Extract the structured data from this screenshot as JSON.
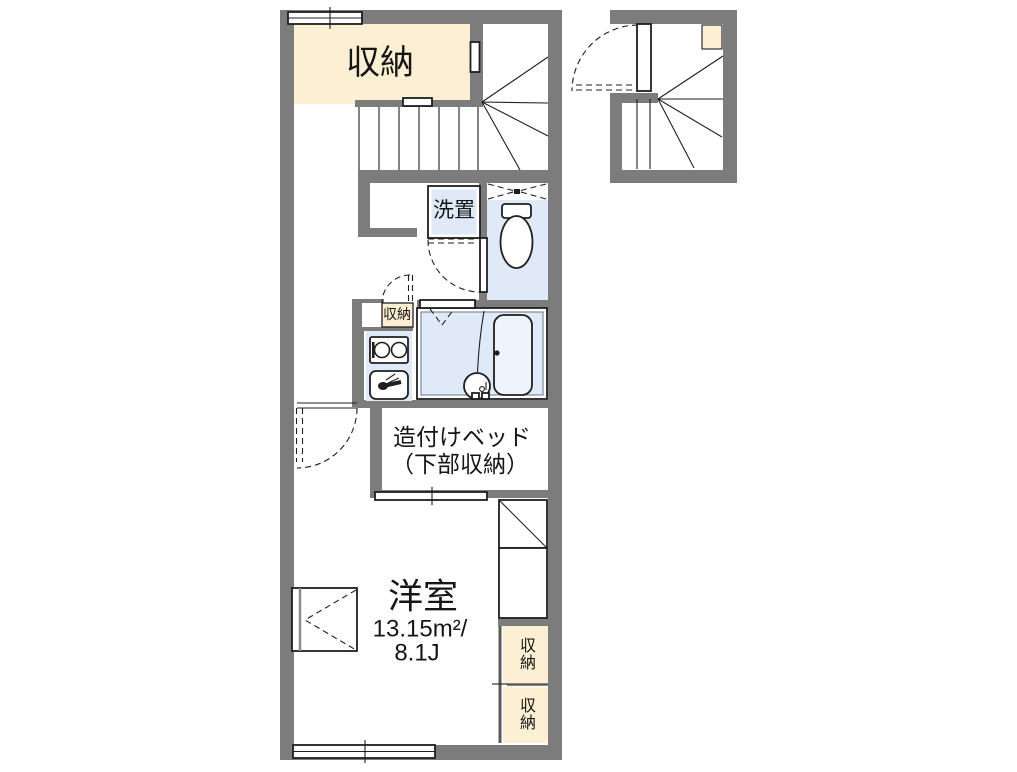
{
  "colors": {
    "wall": "#7c7c7c",
    "cream": "#fcefd3",
    "blue": "#dfe9f8",
    "tub": "#eff4fc",
    "line": "#1f1f1f",
    "rail": "#5a5a5a"
  },
  "labels": {
    "closet_top": "収納",
    "washer": "洗置",
    "closet_small": "収納",
    "bed_line1": "造付けベッド",
    "bed_line2": "（下部収納）",
    "room_name": "洋室",
    "room_area_m2": "13.15m²/",
    "room_area_jo": "8.1J",
    "closet_right_top": "収納",
    "closet_right_bottom": "収納"
  },
  "icons": {
    "toilet": "toilet-icon",
    "bathtub": "bathtub-icon",
    "wash_basin": "wash-basin-icon",
    "stove": "stove-burners-icon",
    "kitchen_sink": "kitchen-sink-icon",
    "stairs_main": "stairs-icon",
    "stairs_external": "external-stairs-icon",
    "door_swing": "door-swing-arc-icon",
    "window": "window-icon",
    "vent_window": "vent-window-icon",
    "sliding_rail": "sliding-door-rail-icon"
  }
}
